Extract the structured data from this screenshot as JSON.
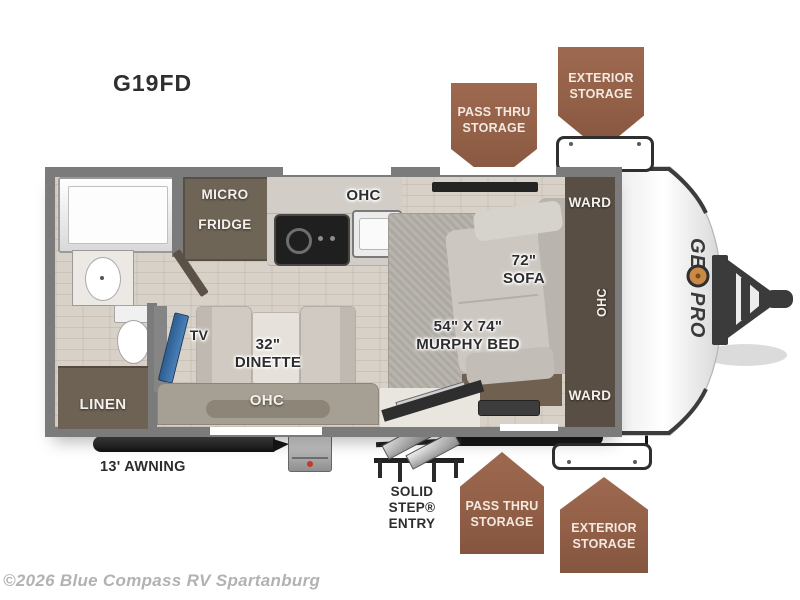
{
  "title": "G19FD",
  "copyright": "©2026 Blue Compass RV Spartanburg",
  "brand": {
    "name": "GEO PRO",
    "prefix": "GE",
    "suffix": "PRO"
  },
  "badges": {
    "top_pass_thru": {
      "line1": "PASS THRU",
      "line2": "STORAGE"
    },
    "top_exterior": {
      "line1": "EXTERIOR",
      "line2": "STORAGE"
    },
    "bottom_pass_thru": {
      "line1": "PASS THRU",
      "line2": "STORAGE"
    },
    "bottom_exterior": {
      "line1": "EXTERIOR",
      "line2": "STORAGE"
    }
  },
  "labels": {
    "micro_fridge": {
      "line1": "MICRO",
      "line2": "FRIDGE"
    },
    "kitchen_ohc": "OHC",
    "ward_top": "WARD",
    "sofa": {
      "line1": "72\"",
      "line2": "SOFA"
    },
    "murphy_bed": {
      "line1": "54\" X 74\"",
      "line2": "MURPHY BED"
    },
    "ohc_right": "OHC",
    "ward_bottom": "WARD",
    "tv": "TV",
    "dinette": {
      "line1": "32\"",
      "line2": "DINETTE"
    },
    "linen": "LINEN",
    "ohc_bottom": "OHC",
    "awning": "13' AWNING",
    "entry": {
      "line1": "SOLID STEP®",
      "line2": "ENTRY"
    }
  },
  "colors": {
    "badge_brown": "#96604A",
    "wall_gray": "#7B7B7B",
    "floor_wood": "#D8D1C7",
    "dark_cabinet": "#6F6557",
    "accent_orange": "#C98A45",
    "tv_blue": "#3A6EA5",
    "label_dark": "#2D2D2D",
    "copyright_gray": "#B2B2B2"
  }
}
